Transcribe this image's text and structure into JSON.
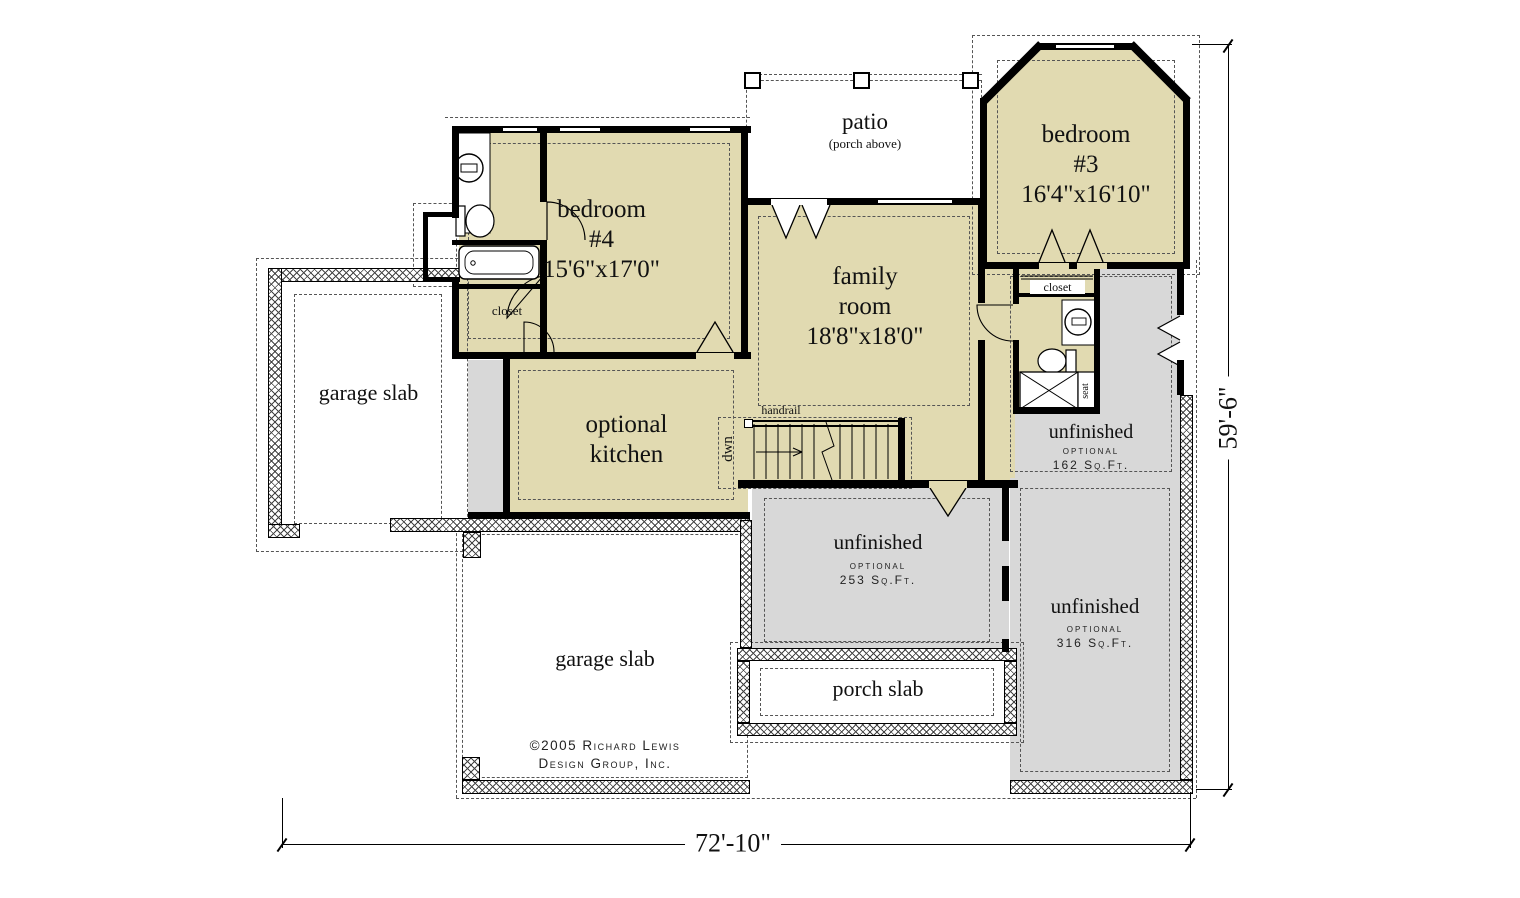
{
  "rooms": {
    "bedroom4": {
      "line1": "bedroom",
      "line2": "#4",
      "line3": "15'6\"x17'0\""
    },
    "bedroom3": {
      "line1": "bedroom",
      "line2": "#3",
      "line3": "16'4\"x16'10\""
    },
    "family_room": {
      "line1": "family",
      "line2": "room",
      "line3": "18'8\"x18'0\""
    },
    "optional_kitchen": {
      "line1": "optional",
      "line2": "kitchen"
    },
    "patio": {
      "line1": "patio",
      "line2": "(porch above)"
    },
    "garage_slab_left": {
      "label": "garage slab"
    },
    "garage_slab_bottom": {
      "label": "garage slab"
    },
    "porch_slab": {
      "label": "porch slab"
    },
    "unfinished_162": {
      "label": "unfinished",
      "sub": "optional",
      "area": "162 Sq.Ft."
    },
    "unfinished_253": {
      "label": "unfinished",
      "sub": "optional",
      "area": "253 Sq.Ft."
    },
    "unfinished_316": {
      "label": "unfinished",
      "sub": "optional",
      "area": "316 Sq.Ft."
    }
  },
  "annotations": {
    "closet_bedroom4": "closet",
    "closet_bedroom3": "closet",
    "handrail": "handrail",
    "stairs_direction": "dwn",
    "shower_seat": "seat"
  },
  "dimensions": {
    "overall_width": "72'-10\"",
    "overall_height": "59'-6\""
  },
  "copyright": {
    "line1": "©2005 Richard Lewis",
    "line2": "Design Group, Inc."
  },
  "colors": {
    "finished_room_fill": "#e1dab1",
    "unfinished_fill": "#d8d8d8",
    "wall": "#000000",
    "paper": "#ffffff"
  }
}
